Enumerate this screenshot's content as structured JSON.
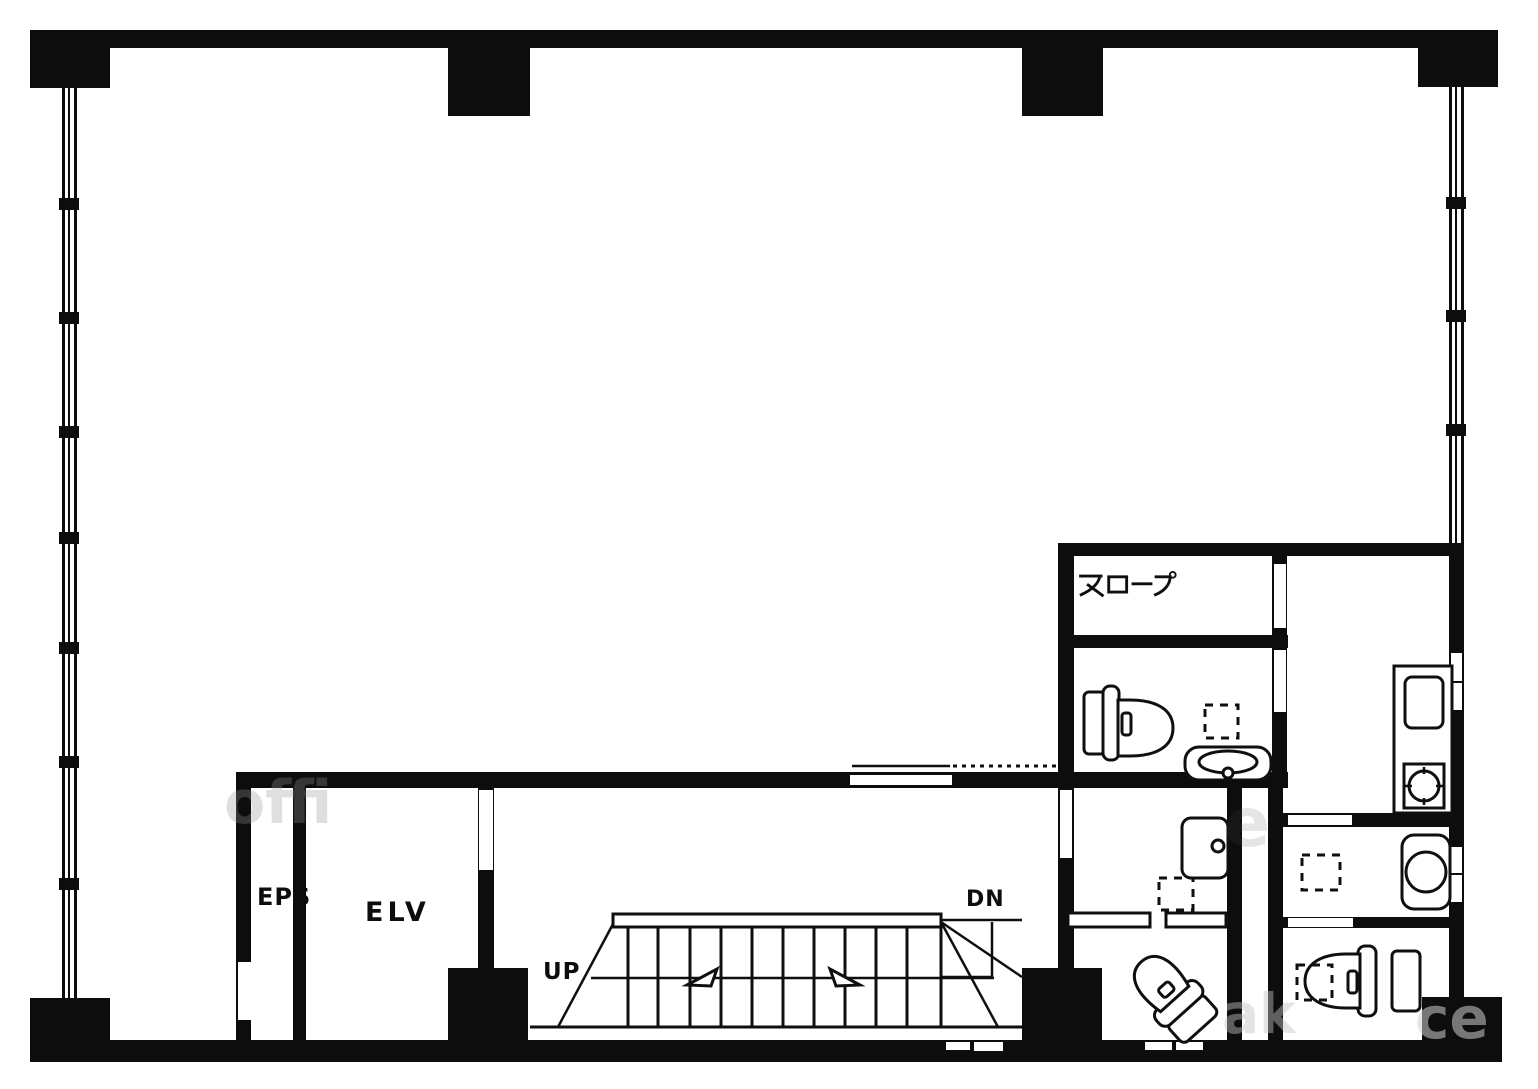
{
  "page": {
    "type": "architectural floor plan",
    "background": "#ffffff",
    "line_color": "#0d0d0d"
  },
  "labels": {
    "slope": "スロープ",
    "eps": "EPS",
    "elv": "ELV",
    "up": "UP",
    "dn": "DN"
  },
  "watermark": {
    "f1": "offi",
    "f2": "e",
    "f3": "ak",
    "f4": "ce"
  }
}
